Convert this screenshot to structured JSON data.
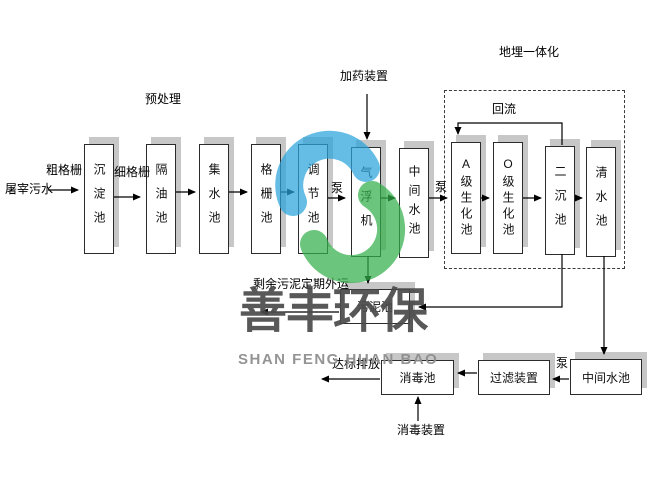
{
  "diagram": {
    "source": "屠宰污水",
    "pretreatment_label": "预处理",
    "coarse_screen": "粗格栅",
    "fine_screen": "细格栅",
    "dosing_label": "加药装置",
    "buried_label": "地埋一体化",
    "reflux_label": "回流",
    "pump": "泵",
    "sludge_out_label": "剩余污泥定期外运",
    "discharge_label": "达标排放",
    "disinfect_device_label": "消毒装置",
    "tanks": [
      {
        "label": "沉淀池"
      },
      {
        "label": "隔油池"
      },
      {
        "label": "集水池"
      },
      {
        "label": "格栅池"
      },
      {
        "label": "调节池"
      },
      {
        "label": "气浮机"
      },
      {
        "label": "中间水池"
      },
      {
        "label": "A级生化池"
      },
      {
        "label": "O级生化池"
      },
      {
        "label": "二沉池"
      },
      {
        "label": "清水池"
      }
    ],
    "bottom_boxes": {
      "sludge": "污泥池",
      "disinfection": "消毒池",
      "filter": "过滤装置",
      "intermediate": "中间水池"
    },
    "line_color": "#000000",
    "shadow_color": "#c7c7c7"
  },
  "watermark": {
    "cn": "善丰环保",
    "en": "SHAN FENG HUAN BAO",
    "blue": "#2aa4dd",
    "green": "#33b04a",
    "text_color": "#4a4a4a"
  }
}
